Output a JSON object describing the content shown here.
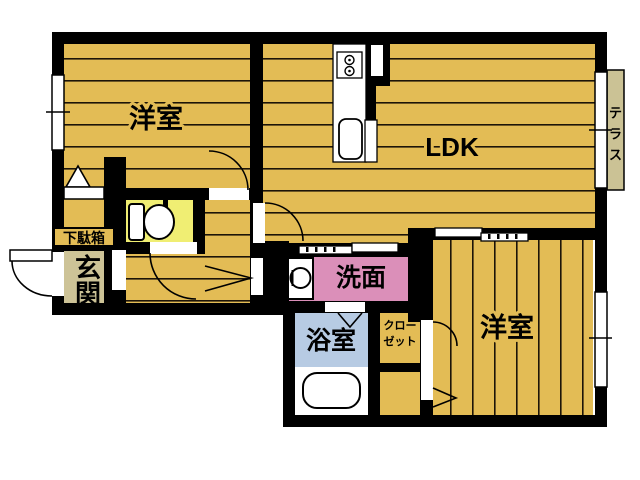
{
  "floorplan": {
    "labels": {
      "bedroom_top_left": "洋室",
      "ldk": "LDK",
      "bedroom_bottom_right": "洋室",
      "washroom": "洗面",
      "bathroom": "浴室",
      "closet_lines": [
        "クロー",
        "ゼット"
      ],
      "entrance": "玄関",
      "shoebox": "下駄箱",
      "terrace": "テラス"
    },
    "colors": {
      "flooring": "#E3BC55",
      "floor_line": "#1C1408",
      "toilet_room": "#F0EE73",
      "entrance": "#CDC397",
      "terrace": "#CBC295",
      "washroom": "#DB8FB9",
      "bathroom": "#B7CBE3",
      "wall": "#000000",
      "background": "#FFFFFF"
    }
  }
}
